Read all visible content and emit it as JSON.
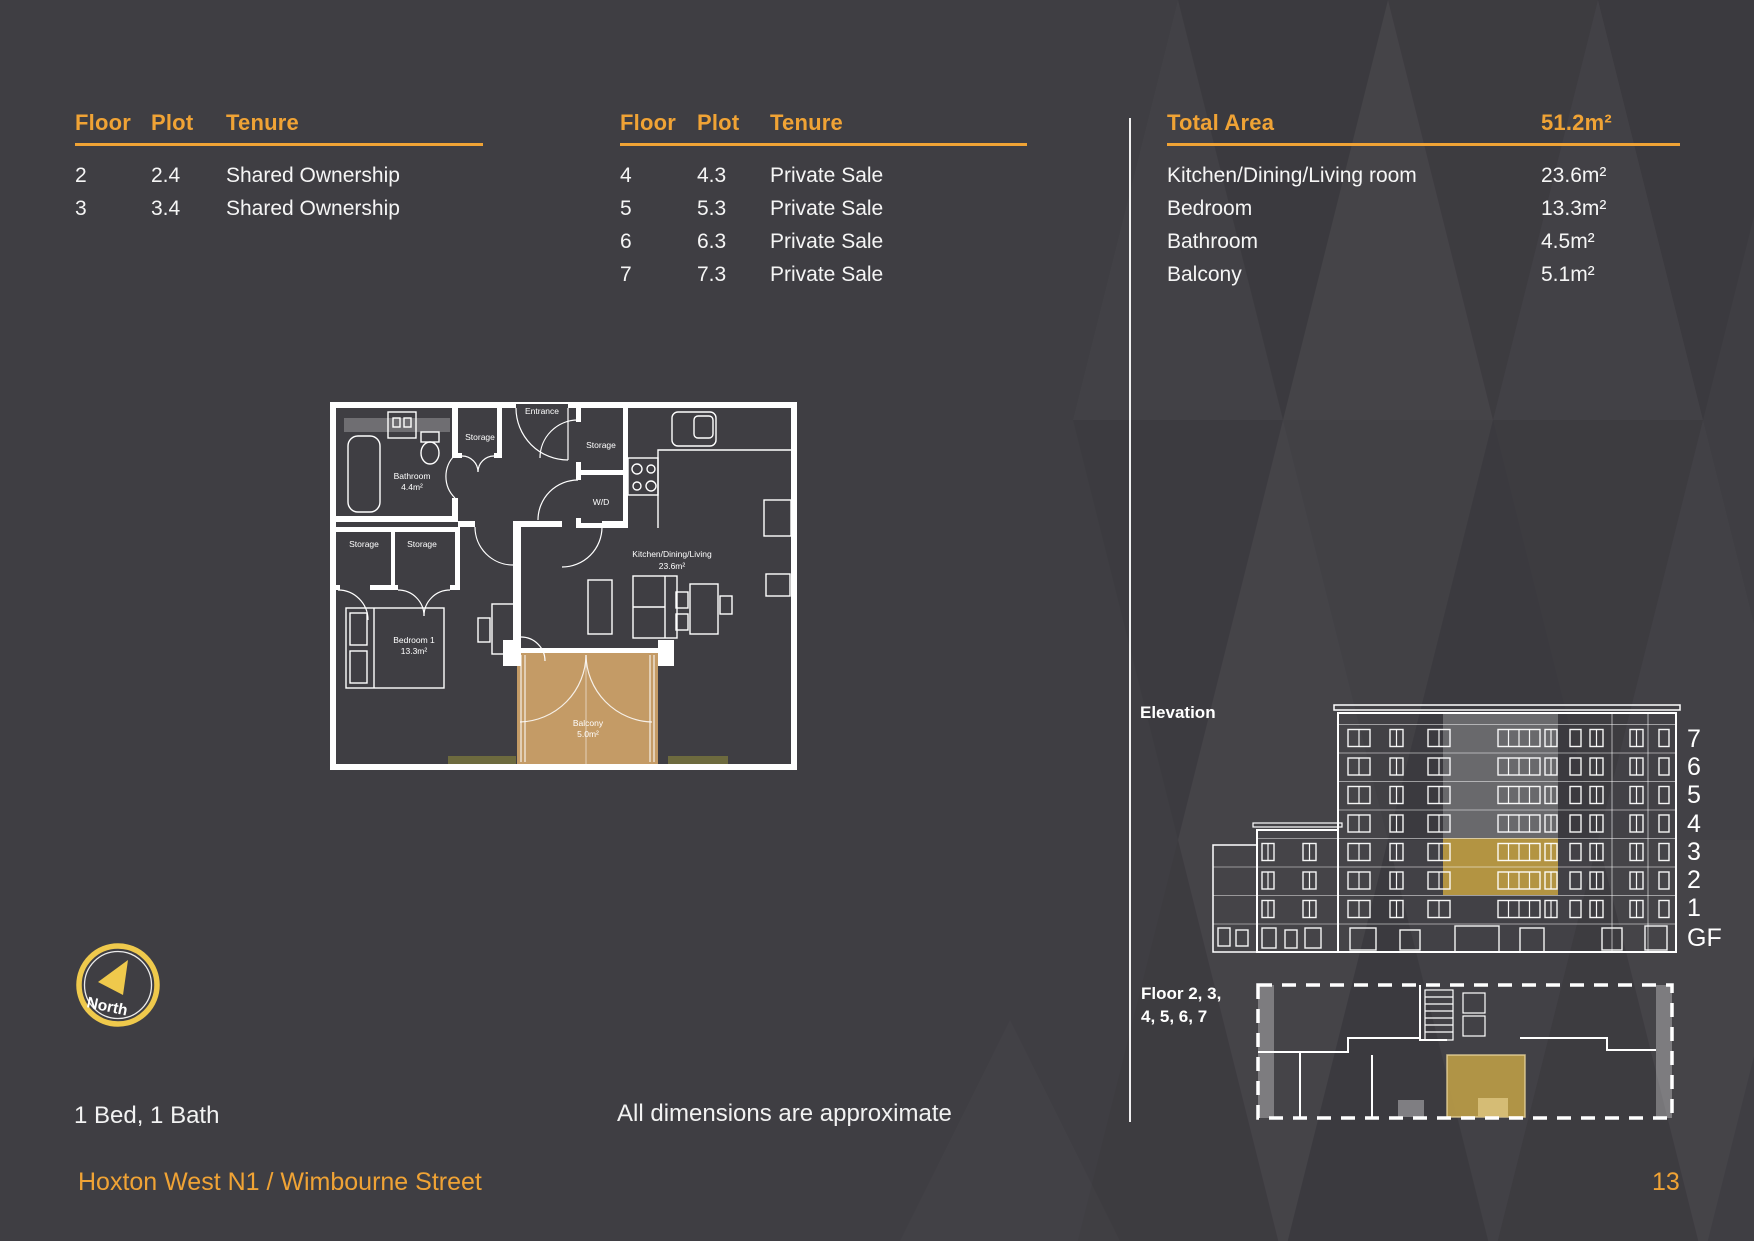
{
  "colors": {
    "background": "#3F3E43",
    "accent_orange": "#F0A335",
    "compass_gold": "#EFC94C",
    "balcony_tan": "#C49B66",
    "highlight_gold": "#C7A342",
    "text_white": "#FFFFFF"
  },
  "tenure_tables": [
    {
      "headers": {
        "floor": "Floor",
        "plot": "Plot",
        "tenure": "Tenure"
      },
      "rows": [
        {
          "floor": "2",
          "plot": "2.4",
          "tenure": "Shared Ownership"
        },
        {
          "floor": "3",
          "plot": "3.4",
          "tenure": "Shared Ownership"
        }
      ]
    },
    {
      "headers": {
        "floor": "Floor",
        "plot": "Plot",
        "tenure": "Tenure"
      },
      "rows": [
        {
          "floor": "4",
          "plot": "4.3",
          "tenure": "Private Sale"
        },
        {
          "floor": "5",
          "plot": "5.3",
          "tenure": "Private Sale"
        },
        {
          "floor": "6",
          "plot": "6.3",
          "tenure": "Private Sale"
        },
        {
          "floor": "7",
          "plot": "7.3",
          "tenure": "Private Sale"
        }
      ]
    }
  ],
  "area_table": {
    "header_label": "Total Area",
    "header_value": "51.2m²",
    "rows": [
      {
        "label": "Kitchen/Dining/Living room",
        "value": "23.6m²"
      },
      {
        "label": "Bedroom",
        "value": "13.3m²"
      },
      {
        "label": "Bathroom",
        "value": "4.5m²"
      },
      {
        "label": "Balcony",
        "value": "5.1m²"
      }
    ]
  },
  "floor_plan": {
    "entrance": "Entrance",
    "storage": "Storage",
    "bathroom": "Bathroom",
    "bathroom_area": "4.4m²",
    "wd": "W/D",
    "kitchen": "Kitchen/Dining/Living",
    "kitchen_area": "23.6m²",
    "bedroom": "Bedroom 1",
    "bedroom_area": "13.3m²",
    "balcony": "Balcony",
    "balcony_area": "5.0m²"
  },
  "elevation": {
    "label": "Elevation",
    "floor_labels": [
      "7",
      "6",
      "5",
      "4",
      "3",
      "2",
      "1",
      "GF"
    ]
  },
  "key_plan": {
    "label_line1": "Floor 2, 3,",
    "label_line2": "4, 5, 6, 7"
  },
  "compass": {
    "label": "North"
  },
  "info": {
    "bed_bath": "1 Bed, 1 Bath",
    "disclaimer": "All dimensions are approximate"
  },
  "footer": {
    "project": "Hoxton West N1 / Wimbourne Street",
    "page_number": "13"
  }
}
